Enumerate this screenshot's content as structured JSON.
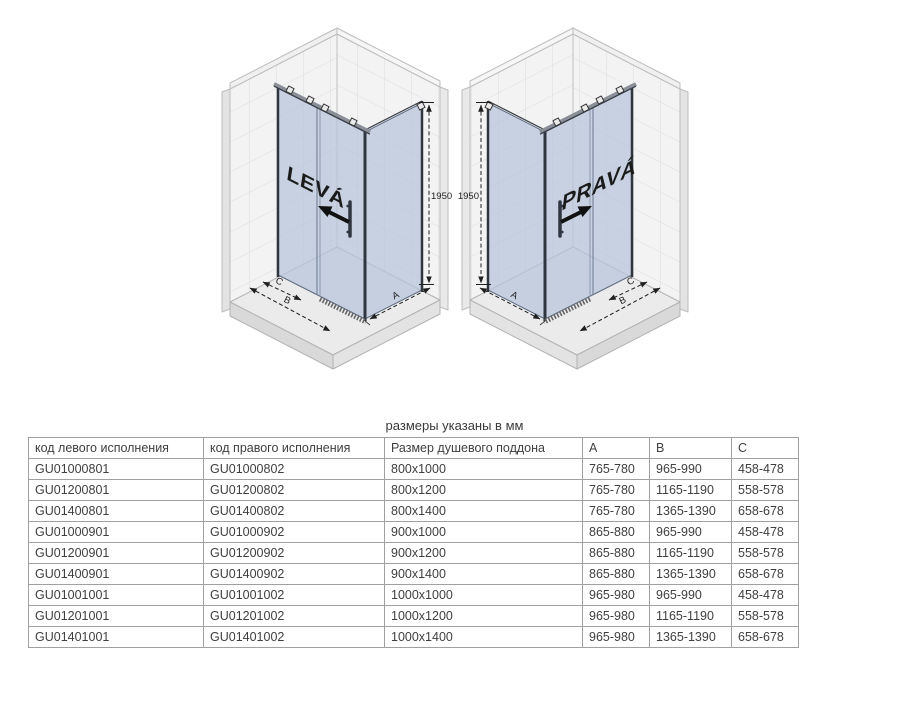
{
  "caption": "размеры указаны в мм",
  "diagrams": {
    "left": {
      "label": "LEVÁ",
      "height": "1950"
    },
    "right": {
      "label": "PRAVÁ",
      "height": "1950"
    },
    "dims": {
      "a": "A",
      "b": "B",
      "c": "C"
    }
  },
  "table": {
    "headers": [
      "код левого исполнения",
      "код правого исполнения",
      "Размер душевого поддона",
      "A",
      "B",
      "C"
    ],
    "rows": [
      [
        "GU01000801",
        "GU01000802",
        "800x1000",
        "765-780",
        "965-990",
        "458-478"
      ],
      [
        "GU01200801",
        "GU01200802",
        "800x1200",
        "765-780",
        "1165-1190",
        "558-578"
      ],
      [
        "GU01400801",
        "GU01400802",
        "800x1400",
        "765-780",
        "1365-1390",
        "658-678"
      ],
      [
        "GU01000901",
        "GU01000902",
        "900x1000",
        "865-880",
        "965-990",
        "458-478"
      ],
      [
        "GU01200901",
        "GU01200902",
        "900x1200",
        "865-880",
        "1165-1190",
        "558-578"
      ],
      [
        "GU01400901",
        "GU01400902",
        "900x1400",
        "865-880",
        "1365-1390",
        "658-678"
      ],
      [
        "GU01001001",
        "GU01001002",
        "1000x1000",
        "965-980",
        "965-990",
        "458-478"
      ],
      [
        "GU01201001",
        "GU01201002",
        "1000x1200",
        "965-980",
        "1165-1190",
        "558-578"
      ],
      [
        "GU01401001",
        "GU01401002",
        "1000x1400",
        "965-980",
        "1365-1390",
        "658-678"
      ]
    ]
  },
  "colors": {
    "glass": "#b7c3da",
    "wall_tile": "#f3f3f3",
    "tile_line": "#dcdcdc",
    "tray": "#ebebeb",
    "dimension": "#1f1f1f",
    "text": "#3f3f3f"
  }
}
